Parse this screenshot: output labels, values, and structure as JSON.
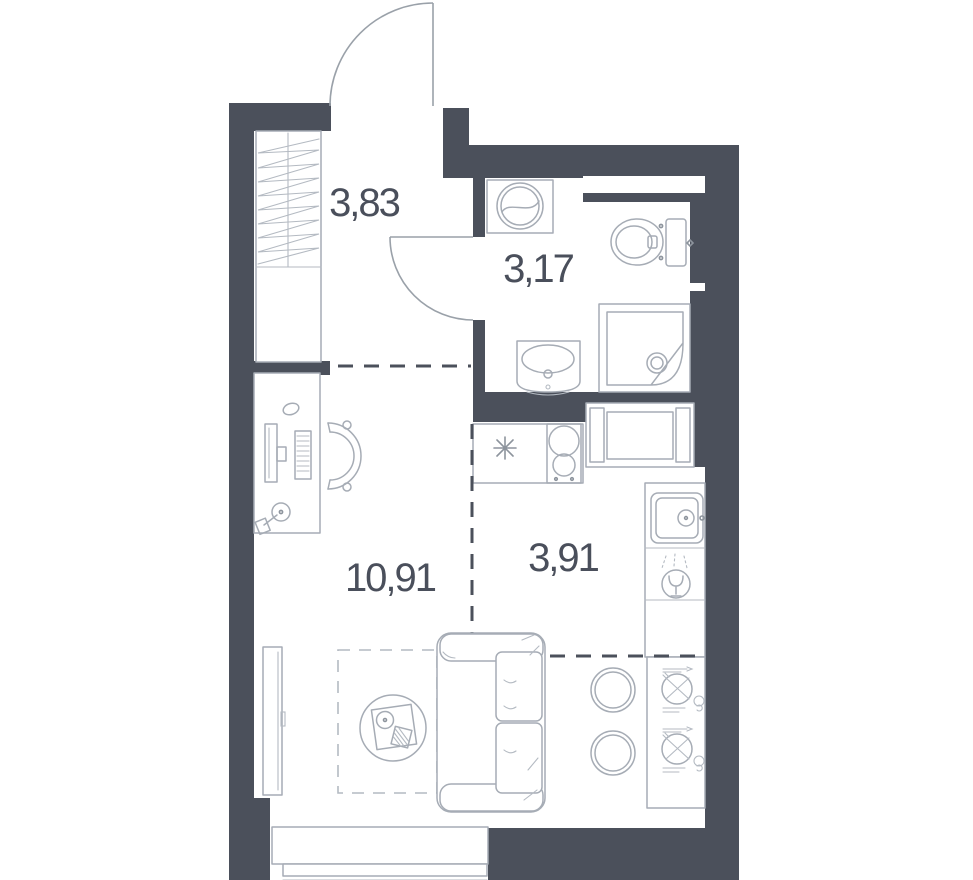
{
  "plan": {
    "type": "studio-apartment-floor-plan",
    "rooms": [
      {
        "name": "hallway",
        "area_m2": "3,83"
      },
      {
        "name": "bathroom",
        "area_m2": "3,17"
      },
      {
        "name": "living-room",
        "area_m2": "10,91"
      },
      {
        "name": "kitchen",
        "area_m2": "3,91"
      }
    ],
    "colors": {
      "wall": "#4b505b",
      "fixture_line": "#a6acb5",
      "fixture_line_dark": "#8d949d",
      "zone_dash": "#4b505b",
      "rug_dash": "#b4bac2",
      "label_text": "#4a4f5b",
      "background": "#ffffff"
    },
    "fixtures": [
      "entry-door",
      "wardrobe",
      "bathroom-door",
      "washing-machine",
      "toilet",
      "bathroom-sink",
      "shower-cabin",
      "ventilation-niche",
      "fridge-spot-asterisk",
      "cooktop",
      "built-in-appliance",
      "kitchen-sink",
      "dishwasher-glass",
      "dining-table",
      "stool",
      "desk",
      "office-chair",
      "monitor",
      "keyboard",
      "mouse",
      "desk-lamp",
      "tv",
      "sofa",
      "coffee-table",
      "rug",
      "window"
    ]
  }
}
